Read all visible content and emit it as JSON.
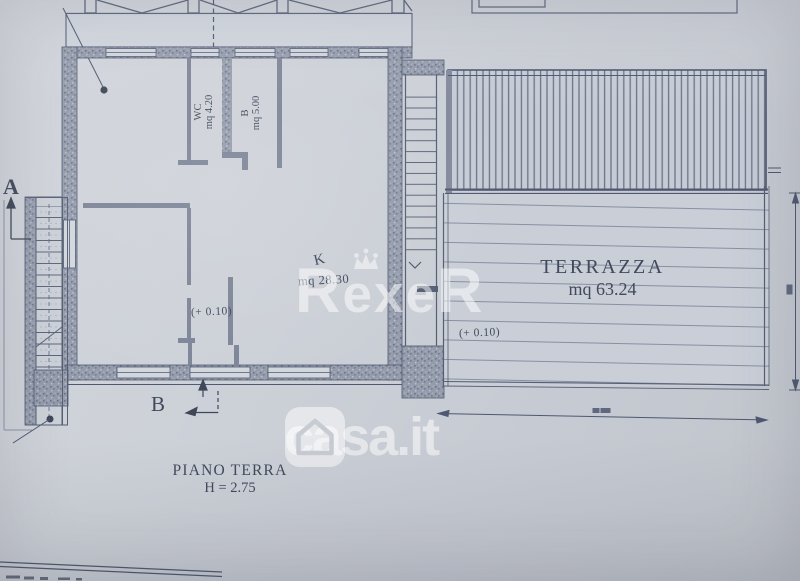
{
  "rooms": {
    "wc": {
      "name": "WC",
      "area": "mq 4.20"
    },
    "bath": {
      "name": "B",
      "area": "mq 5.00"
    },
    "kitchen": {
      "name": "K",
      "area": "mq 28.30"
    },
    "terrace": {
      "name": "TERRAZZA",
      "area": "mq 63.24"
    }
  },
  "elevations": {
    "interior": "(+ 0.10)",
    "terrace": "(+ 0.10)"
  },
  "sections": {
    "a": "A",
    "b": "B"
  },
  "title": {
    "floor": "PIANO TERRA",
    "height": "H = 2.75"
  },
  "watermarks": {
    "rexer": {
      "first": "R",
      "middle": "exe",
      "last": "R"
    },
    "casa": {
      "text": "casa.it"
    }
  }
}
